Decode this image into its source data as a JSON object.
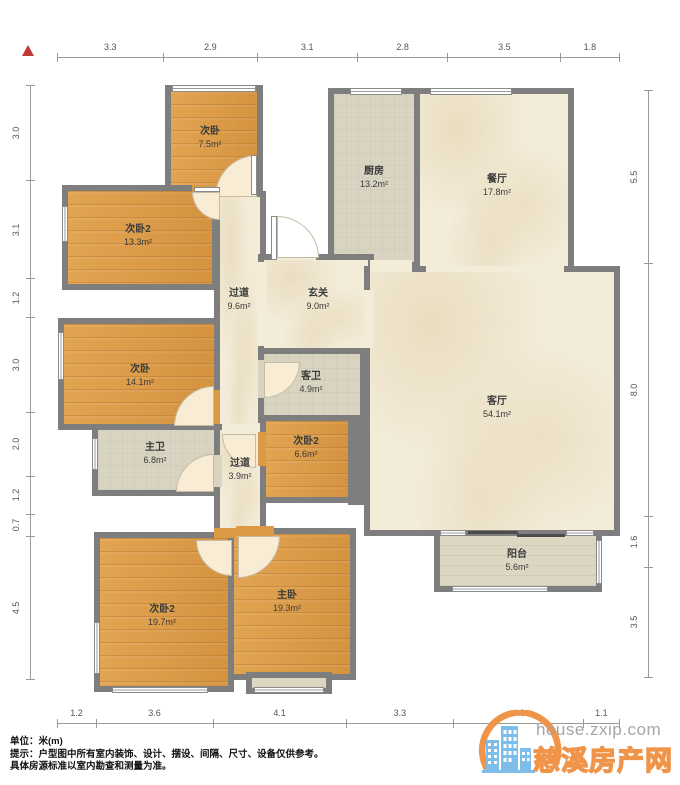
{
  "plan": {
    "wall_color": "#7e7e7e",
    "floor_colors": {
      "wood": "#dc9a45",
      "cream": "#f3ecd9",
      "tile": "#d8d4c1",
      "balcony": "#dbd7c2",
      "pale": "#f8ecd4",
      "white": "#ffffff"
    },
    "rooms": [
      {
        "id": "bedroom-top",
        "name": "次卧",
        "area": "7.5m²",
        "type": "wood",
        "rect": [
          165,
          85,
          98,
          112
        ],
        "label": [
          210,
          138
        ]
      },
      {
        "id": "bedroom2-upper",
        "name": "次卧2",
        "area": "13.3m²",
        "type": "wood",
        "rect": [
          62,
          185,
          156,
          105
        ],
        "label": [
          138,
          236
        ]
      },
      {
        "id": "kitchen",
        "name": "厨房",
        "area": "13.2m²",
        "type": "tile",
        "rect": [
          328,
          88,
          92,
          180
        ],
        "label": [
          374,
          178
        ]
      },
      {
        "id": "dining",
        "name": "餐厅",
        "area": "17.8m²",
        "type": "cream",
        "rect": [
          414,
          88,
          160,
          184
        ],
        "label": [
          497,
          186
        ]
      },
      {
        "id": "hallway-main",
        "name": "过道",
        "area": "9.6m²",
        "type": "cream",
        "rect": [
          214,
          191,
          52,
          245
        ],
        "label": [
          239,
          300
        ]
      },
      {
        "id": "foyer",
        "name": "玄关",
        "area": "9.0m²",
        "type": "cream",
        "rect": [
          258,
          254,
          116,
          100
        ],
        "label": [
          318,
          300
        ]
      },
      {
        "id": "bedroom-mid",
        "name": "次卧",
        "area": "14.1m²",
        "type": "wood",
        "rect": [
          58,
          318,
          162,
          112
        ],
        "label": [
          140,
          376
        ]
      },
      {
        "id": "bath-guest",
        "name": "客卫",
        "area": "4.9m²",
        "type": "tile",
        "rect": [
          258,
          348,
          108,
          75
        ],
        "label": [
          311,
          383
        ]
      },
      {
        "id": "bath-master",
        "name": "主卫",
        "area": "6.8m²",
        "type": "tile",
        "rect": [
          92,
          424,
          130,
          72
        ],
        "label": [
          155,
          454
        ]
      },
      {
        "id": "hallway-small",
        "name": "过道",
        "area": "3.9m²",
        "type": "cream",
        "rect": [
          214,
          424,
          52,
          112
        ],
        "label": [
          240,
          470
        ]
      },
      {
        "id": "bedroom2-small",
        "name": "次卧2",
        "area": "6.6m²",
        "type": "wood",
        "rect": [
          260,
          415,
          94,
          88
        ],
        "label": [
          306,
          448
        ]
      },
      {
        "id": "living",
        "name": "客厅",
        "area": "54.1m²",
        "type": "cream",
        "rect": [
          364,
          266,
          256,
          270
        ],
        "label": [
          497,
          408
        ]
      },
      {
        "id": "balcony",
        "name": "阳台",
        "area": "5.6m²",
        "type": "balcony",
        "rect": [
          434,
          530,
          168,
          62
        ],
        "label": [
          517,
          561
        ]
      },
      {
        "id": "bedroom2-lower",
        "name": "次卧2",
        "area": "19.7m²",
        "type": "wood",
        "rect": [
          94,
          532,
          140,
          160
        ],
        "label": [
          162,
          616
        ]
      },
      {
        "id": "master",
        "name": "主卧",
        "area": "19.3m²",
        "type": "wood",
        "rect": [
          228,
          528,
          128,
          152
        ],
        "label": [
          287,
          602
        ]
      },
      {
        "id": "bay-window",
        "name": "",
        "area": "",
        "type": "balcony",
        "rect": [
          246,
          672,
          86,
          22
        ],
        "label": [
          0,
          0
        ]
      }
    ],
    "extra_walls": [
      [
        348,
        415,
        18,
        90
      ]
    ],
    "openings": [
      {
        "rect": [
          257,
          262,
          10,
          84
        ],
        "floor": "cream"
      },
      {
        "rect": [
          222,
          424,
          38,
          12
        ],
        "floor": "cream"
      },
      {
        "rect": [
          426,
          266,
          138,
          6
        ],
        "floor": "cream"
      },
      {
        "rect": [
          364,
          290,
          10,
          58
        ],
        "floor": "cream"
      },
      {
        "rect": [
          276,
          254,
          40,
          6
        ],
        "floor": "cream"
      },
      {
        "rect": [
          370,
          260,
          42,
          12
        ],
        "floor": "cream"
      },
      {
        "rect": [
          236,
          526,
          38,
          10
        ],
        "floor": "wood"
      },
      {
        "rect": [
          258,
          432,
          8,
          34
        ],
        "floor": "wood"
      },
      {
        "rect": [
          222,
          191,
          34,
          6
        ],
        "floor": "wood"
      },
      {
        "rect": [
          192,
          185,
          28,
          12
        ],
        "floor": "wood"
      },
      {
        "rect": [
          214,
          390,
          6,
          34
        ],
        "floor": "wood"
      },
      {
        "rect": [
          258,
          360,
          8,
          38
        ],
        "floor": "tile"
      },
      {
        "rect": [
          214,
          528,
          22,
          10
        ],
        "floor": "wood"
      },
      {
        "rect": [
          214,
          455,
          8,
          32
        ],
        "floor": "tile"
      }
    ],
    "windows": [
      [
        172,
        85,
        84,
        7,
        "h"
      ],
      [
        350,
        88,
        52,
        7,
        "h"
      ],
      [
        430,
        88,
        82,
        7,
        "h"
      ],
      [
        62,
        206,
        6,
        36,
        "v"
      ],
      [
        58,
        332,
        6,
        48,
        "v"
      ],
      [
        92,
        438,
        6,
        32,
        "v"
      ],
      [
        94,
        622,
        6,
        52,
        "v"
      ],
      [
        112,
        687,
        96,
        6,
        "h"
      ],
      [
        254,
        687,
        70,
        6,
        "h"
      ],
      [
        596,
        540,
        6,
        44,
        "v"
      ],
      [
        452,
        586,
        96,
        6,
        "h"
      ],
      [
        440,
        530,
        26,
        6,
        "h"
      ],
      [
        566,
        530,
        28,
        6,
        "h"
      ]
    ],
    "doors": [
      {
        "rect": [
          215,
          155,
          42
        ],
        "corner": "tl",
        "floor": "pale"
      },
      {
        "rect": [
          192,
          192,
          28
        ],
        "corner": "bl",
        "floor": "pale"
      },
      {
        "rect": [
          277,
          216,
          42
        ],
        "corner": "tr",
        "floor": "white"
      },
      {
        "rect": [
          264,
          362,
          36
        ],
        "corner": "br",
        "floor": "pale"
      },
      {
        "rect": [
          174,
          386,
          40
        ],
        "corner": "tl",
        "floor": "pale"
      },
      {
        "rect": [
          176,
          454,
          38
        ],
        "corner": "tl",
        "floor": "pale"
      },
      {
        "rect": [
          222,
          434,
          34
        ],
        "corner": "bl",
        "floor": "pale"
      },
      {
        "rect": [
          238,
          536,
          42
        ],
        "corner": "br",
        "floor": "pale"
      },
      {
        "rect": [
          196,
          540,
          36
        ],
        "corner": "bl",
        "floor": "pale"
      }
    ],
    "door_leaves": [
      [
        251,
        155,
        6,
        40
      ],
      [
        194,
        187,
        26,
        5
      ],
      [
        271,
        216,
        6,
        44
      ]
    ],
    "sliders": [
      [
        468,
        531,
        50,
        3
      ],
      [
        517,
        534,
        48,
        3
      ]
    ],
    "dimensions": {
      "top": {
        "values": [
          "3.3",
          "2.9",
          "3.1",
          "2.8",
          "3.5",
          "1.8"
        ],
        "x0": 57,
        "y": 57,
        "ppm": 32.3
      },
      "bottom": {
        "values": [
          "1.2",
          "3.6",
          "4.1",
          "3.3",
          "4.0",
          "1.1"
        ],
        "x0": 57,
        "y": 723,
        "ppm": 32.5
      },
      "left": {
        "values": [
          "3.0",
          "3.1",
          "1.2",
          "3.0",
          "2.0",
          "1.2",
          "0.7",
          "4.5"
        ],
        "x": 30,
        "y0": 85,
        "ppm": 31.8
      },
      "right": {
        "values": [
          "5.5",
          "8.0",
          "1.6",
          "3.5"
        ],
        "x": 648,
        "y0": 90,
        "ppm": 31.6
      }
    }
  },
  "footer": {
    "unit_line": "单位：米(m)",
    "tip_line": "提示：户型图中所有室内装饰、设计、摆设、间隔、尺寸、设备仅供参考。",
    "tip_line2": "具体房源标准以室内勘查和测量为准。"
  },
  "watermark": {
    "domain": "house.zxip.com",
    "site_name": "慈溪房产网",
    "accent_color": "#ef9449",
    "icon_color": "#7cbde9",
    "domain_color": "#a6a6a6"
  }
}
